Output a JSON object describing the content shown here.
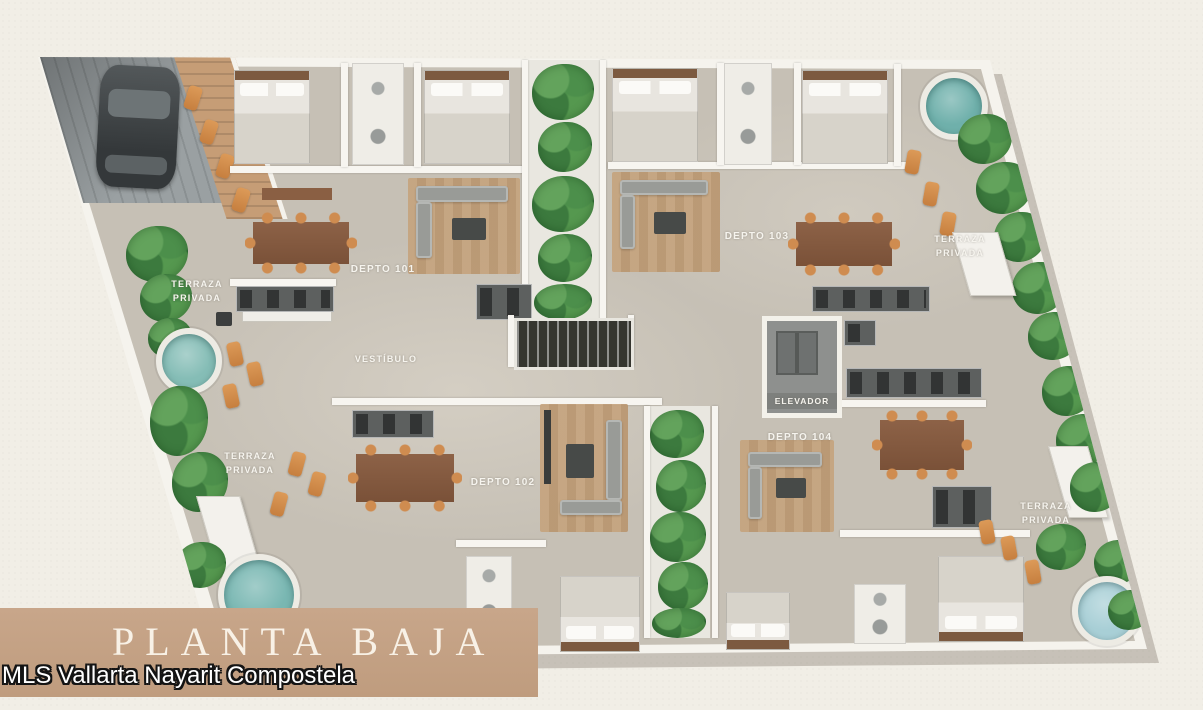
{
  "page": {
    "background_color": "#f1eee6"
  },
  "banner": {
    "title": "PLANTA BAJA",
    "background_color": "#c5a287",
    "text_color": "#f8f1e6"
  },
  "watermark": {
    "text": "MLS Vallarta Nayarit Compostela"
  },
  "floor_plan": {
    "units": [
      {
        "id": "depto-101",
        "label": "DEPTO 101"
      },
      {
        "id": "depto-102",
        "label": "DEPTO 102"
      },
      {
        "id": "depto-103",
        "label": "DEPTO 103"
      },
      {
        "id": "depto-104",
        "label": "DEPTO 104"
      }
    ],
    "common_areas": {
      "lobby": "VESTÍBULO",
      "elevator": "ELEVADOR"
    },
    "terraces": [
      {
        "id": "terrace-upper-left",
        "label": "TERRAZA\nPRIVADA"
      },
      {
        "id": "terrace-upper-right",
        "label": "TERRAZA\nPRIVADA"
      },
      {
        "id": "terrace-lower-left",
        "label": "TERRAZA\nPRIVADA"
      },
      {
        "id": "terrace-lower-right",
        "label": "TERRAZA\nPRIVADA"
      }
    ],
    "graphics": [
      "carport-car",
      "round-pools",
      "staircase",
      "landscaping",
      "lounge-chairs"
    ],
    "colors": {
      "floor": "#c6c0b5",
      "walls": "#f5f3ed",
      "greenery": "#3e7a42",
      "pool_water": "#7fb7b1",
      "wood": "#8a5f43",
      "kitchen": "#5d605f",
      "lounge_chairs": "#cf8c50"
    }
  }
}
